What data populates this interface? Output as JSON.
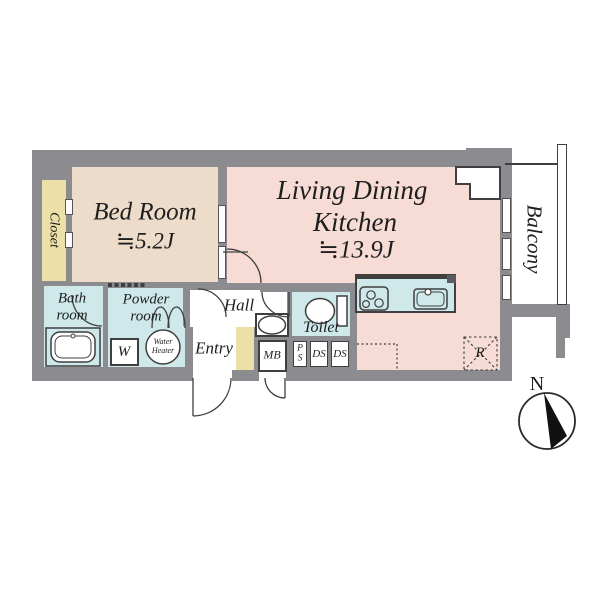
{
  "colors": {
    "wall": "#8b8b90",
    "outline": "#3f3f3f",
    "bedroom_fill": "#ecdcc9",
    "ldk_fill": "#f7dcd6",
    "wet_area_fill": "#cfe8ea",
    "closet_fill": "#ece0a8",
    "paper": "#ffffff",
    "compass_needle": "#111111"
  },
  "rooms": {
    "bedroom": {
      "name": "Bed Room",
      "size": "≒5.2J"
    },
    "ldk": {
      "line1": "Living Dining",
      "line2": "Kitchen",
      "size": "≒13.9J"
    },
    "closet": {
      "name": "Closet"
    },
    "balcony": {
      "name": "Balcony"
    },
    "bathroom": {
      "line1": "Bath",
      "line2": "room"
    },
    "powder_room": {
      "line1": "Powder",
      "line2": "room"
    },
    "hall": {
      "name": "Hall"
    },
    "entry": {
      "name": "Entry"
    },
    "toilet": {
      "name": "Toilet"
    }
  },
  "fixtures": {
    "washing_machine": {
      "label": "W"
    },
    "water_heater": {
      "line1": "Water",
      "line2": "Heater"
    },
    "meter_box": {
      "label": "MB"
    },
    "pipe_space": {
      "line1": "P",
      "line2": "S"
    },
    "duct_space_1": {
      "label": "DS"
    },
    "duct_space_2": {
      "label": "DS"
    },
    "refrigerator_space": {
      "label": "R"
    }
  },
  "compass": {
    "label": "N"
  }
}
